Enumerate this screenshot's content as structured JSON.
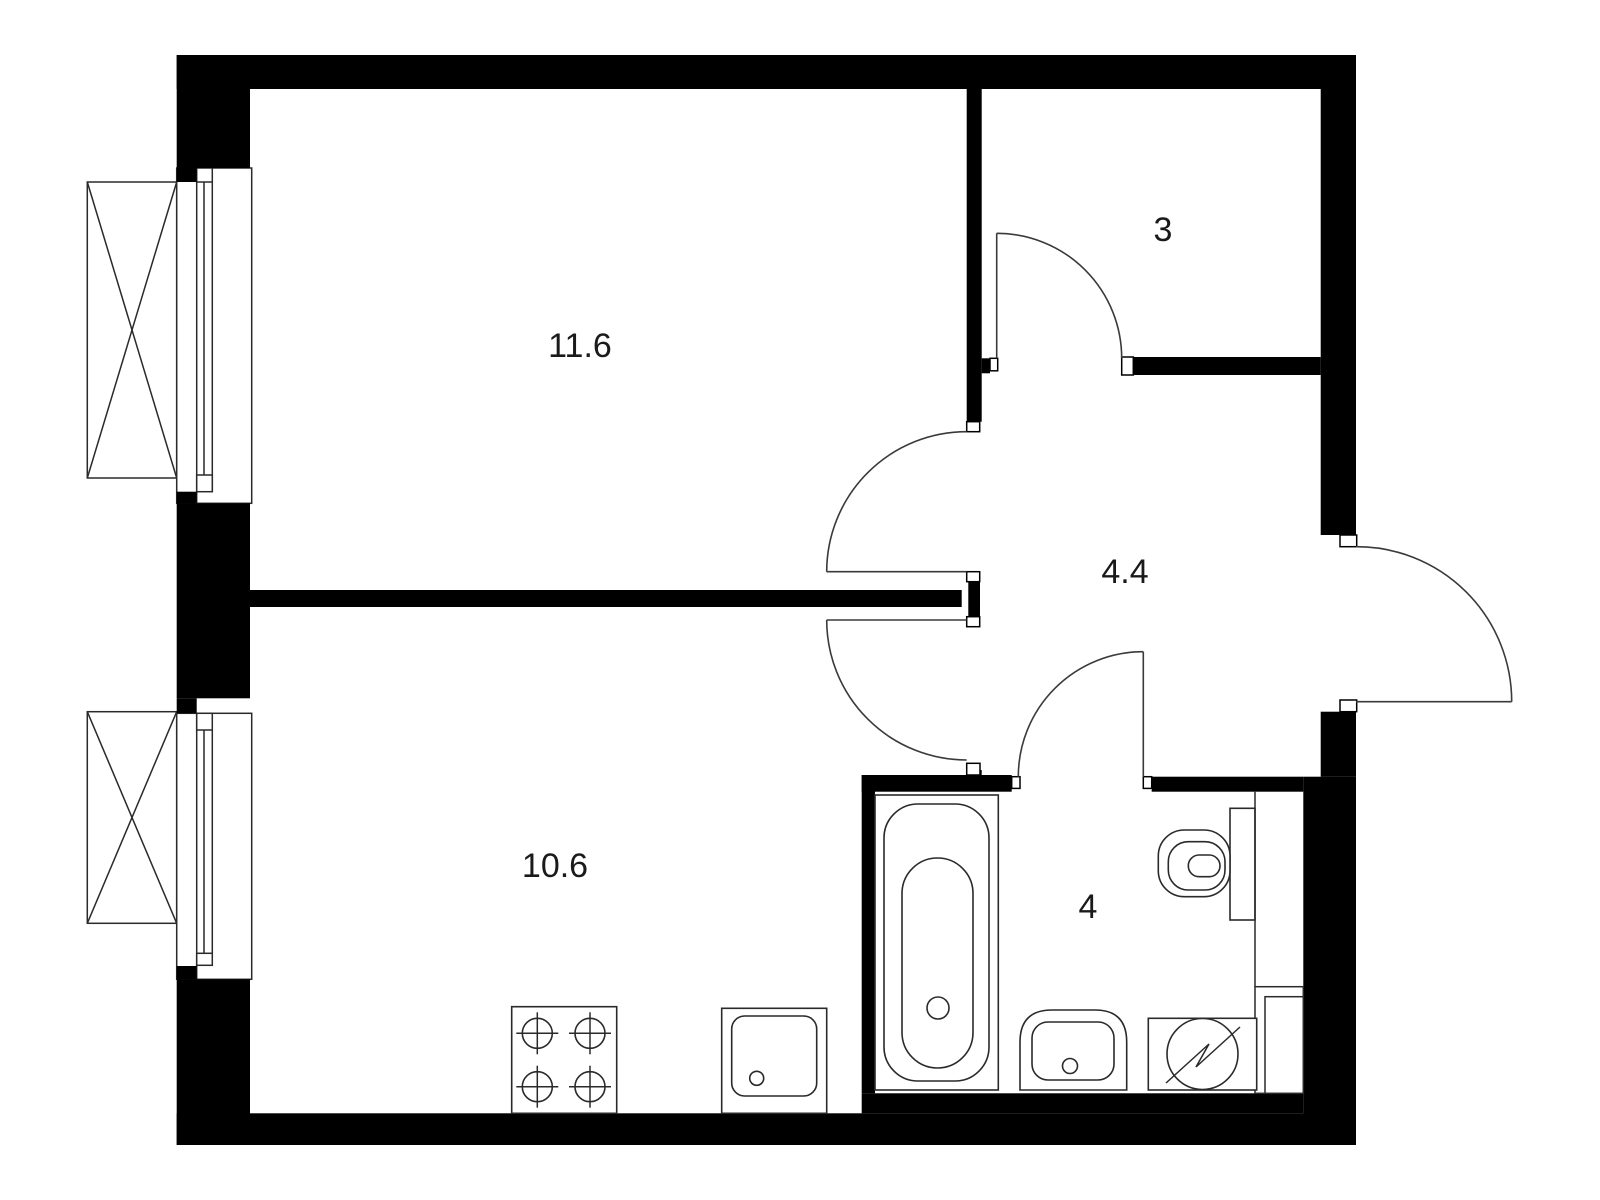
{
  "page": {
    "title": "Apartment floor plan",
    "background": "#ffffff",
    "wall_color": "#000000",
    "outline_color": "#2a2a2a"
  },
  "rooms": {
    "living": {
      "id": "room-living",
      "label": "11.6"
    },
    "top_right": {
      "id": "room-3",
      "label": "3"
    },
    "hallway": {
      "id": "room-hallway",
      "label": "4.4"
    },
    "kitchen": {
      "id": "room-kitchen",
      "label": "10.6"
    },
    "bathroom": {
      "id": "room-bathroom",
      "label": "4"
    }
  },
  "fixtures": [
    {
      "id": "window-top-left",
      "type": "window-with-balcony-box"
    },
    {
      "id": "window-bottom-left",
      "type": "window-with-balcony-box"
    },
    {
      "id": "bathtub",
      "type": "bathtub"
    },
    {
      "id": "toilet",
      "type": "toilet-with-cistern"
    },
    {
      "id": "wash-basin",
      "type": "bathroom-sink"
    },
    {
      "id": "washing-machine",
      "type": "washing-machine"
    },
    {
      "id": "cooktop",
      "type": "stove-4-burners"
    },
    {
      "id": "kitchen-sink",
      "type": "kitchen-sink"
    },
    {
      "id": "door-living",
      "type": "interior-door"
    },
    {
      "id": "door-kitchen",
      "type": "interior-door"
    },
    {
      "id": "door-room-3",
      "type": "interior-door"
    },
    {
      "id": "door-bathroom",
      "type": "interior-door"
    },
    {
      "id": "entrance-door",
      "type": "entrance-door-outswing"
    }
  ]
}
